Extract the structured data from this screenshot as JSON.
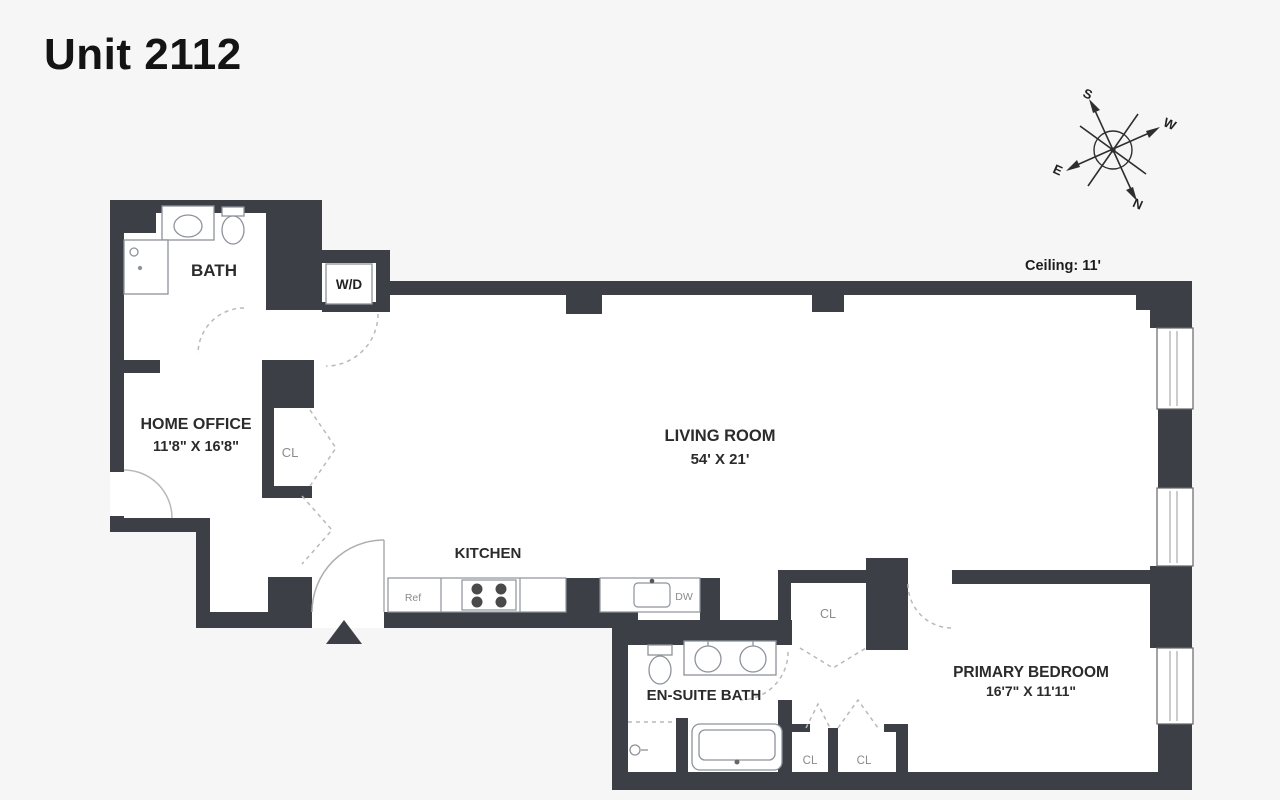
{
  "page": {
    "title": "Unit 2112"
  },
  "plan": {
    "ceiling_note": "Ceiling: 11'",
    "compass": {
      "n": "N",
      "s": "S",
      "e": "E",
      "w": "W"
    },
    "rooms": {
      "bath": {
        "label": "BATH"
      },
      "home_office": {
        "label": "HOME OFFICE",
        "dimensions": "11'8\" X 16'8\""
      },
      "living_room": {
        "label": "LIVING ROOM",
        "dimensions": "54' X 21'"
      },
      "kitchen": {
        "label": "KITCHEN"
      },
      "ensuite_bath": {
        "label": "EN-SUITE BATH"
      },
      "primary_bedroom": {
        "label": "PRIMARY BEDROOM",
        "dimensions": "16'7\" X 11'11\""
      }
    },
    "closet_label": "CL",
    "washer_dryer_label": "W/D",
    "appliances": {
      "refrigerator": "Ref",
      "dishwasher": "DW"
    },
    "colors": {
      "wall": "#3c4046",
      "fixture_line": "#8d939b",
      "door_swing": "#b9b9b9",
      "text": "#2b2b2b",
      "muted_text": "#8b8b8b",
      "background": "#f6f6f7"
    }
  }
}
